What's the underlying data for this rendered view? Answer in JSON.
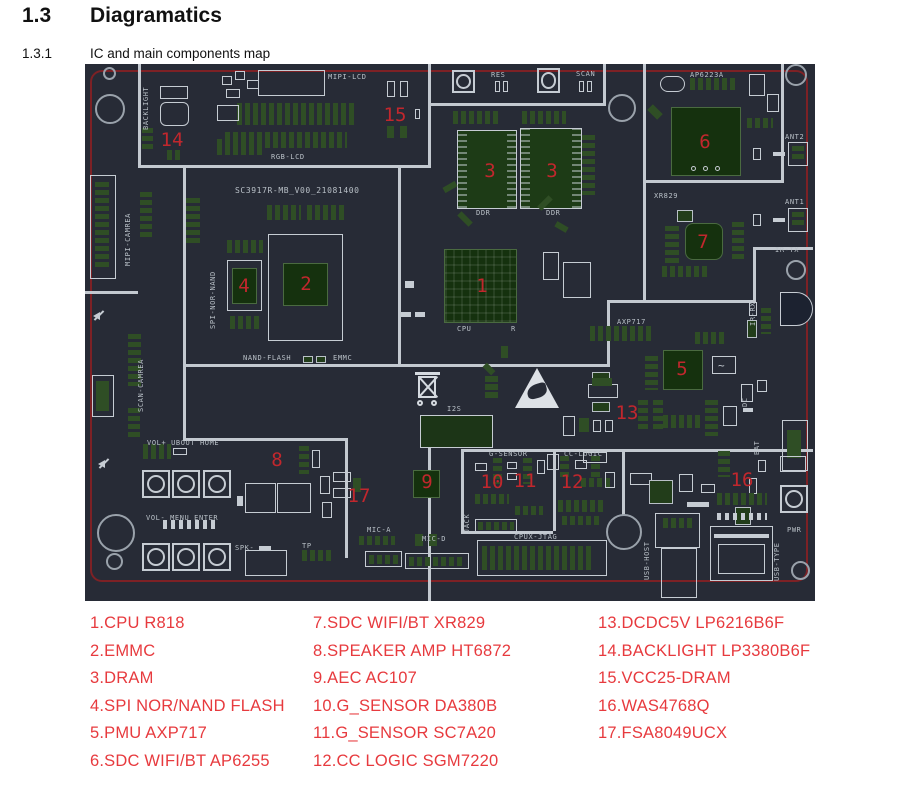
{
  "page": {
    "section_number": "1.3",
    "section_title": "Diagramatics",
    "subsection_number": "1.3.1",
    "subsection_title": "IC and main components map"
  },
  "board": {
    "title": "SC3917R-MB_V00_21081400",
    "colors": {
      "background": "#272b36",
      "silkscreen": "#c6ccd3",
      "pad_green": "#2f4e25",
      "chip_green": "#15310e",
      "outline_red": "#7d2125",
      "marker_red": "#c1272d"
    },
    "labels": [
      {
        "text": "BACKLIGHT"
      },
      {
        "text": "MIPI-LCD"
      },
      {
        "text": "RGB-LCD"
      },
      {
        "text": "RES"
      },
      {
        "text": "SCAN"
      },
      {
        "text": "AP6223A"
      },
      {
        "text": "ANT2"
      },
      {
        "text": "ANT1"
      },
      {
        "text": "XR829"
      },
      {
        "text": "IR-TX"
      },
      {
        "text": "IR-RX"
      },
      {
        "text": "MIPI-CAMREA"
      },
      {
        "text": "SPI-NOR-NAND"
      },
      {
        "text": "SCAN-CAMREA"
      },
      {
        "text": "NAND-FLASH"
      },
      {
        "text": "EMMC"
      },
      {
        "text": "CPU"
      },
      {
        "text": "R"
      },
      {
        "text": "DDR"
      },
      {
        "text": "DDR"
      },
      {
        "text": "AXP717"
      },
      {
        "text": "I2S"
      },
      {
        "text": "VOL+ UBOOT HOME"
      },
      {
        "text": "VOL- MENU ENTER"
      },
      {
        "text": "SPK-"
      },
      {
        "text": "TP"
      },
      {
        "text": "MIC-A"
      },
      {
        "text": "MIC-D"
      },
      {
        "text": "JACK"
      },
      {
        "text": "G-SENSOR"
      },
      {
        "text": "CC-LOGIC"
      },
      {
        "text": "CPUX-JTAG"
      },
      {
        "text": "USB-HOST"
      },
      {
        "text": "USB-TYPE"
      },
      {
        "text": "PWR"
      },
      {
        "text": "DC"
      },
      {
        "text": "BAT"
      }
    ],
    "numbers": [
      "1",
      "2",
      "3",
      "3",
      "4",
      "5",
      "6",
      "7",
      "8",
      "9",
      "10",
      "11",
      "12",
      "13",
      "14",
      "15",
      "16",
      "17"
    ]
  },
  "legend": {
    "color": "#e73a3e",
    "columns": [
      [
        "1.CPU R818",
        "2.EMMC",
        "3.DRAM",
        "4.SPI NOR/NAND FLASH",
        "5.PMU AXP717",
        "6.SDC WIFI/BT AP6255"
      ],
      [
        "7.SDC WIFI/BT XR829",
        "8.SPEAKER AMP HT6872",
        "9.AEC AC107",
        "10.G_SENSOR DA380B",
        "11.G_SENSOR SC7A20",
        "12.CC LOGIC SGM7220"
      ],
      [
        "13.DCDC5V LP6216B6F",
        "14.BACKLIGHT LP3380B6F",
        "15.VCC25-DRAM",
        "16.WAS4768Q",
        "17.FSA8049UCX"
      ]
    ]
  }
}
